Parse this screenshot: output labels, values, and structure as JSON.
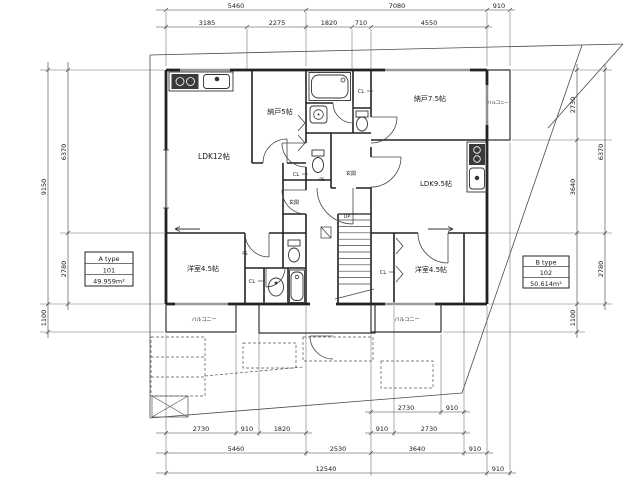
{
  "plan": {
    "unit_tables": {
      "a": {
        "type_label": "A type",
        "unit_no": "101",
        "area": "49.959m²"
      },
      "b": {
        "type_label": "B type",
        "unit_no": "102",
        "area": "50.614m²"
      }
    },
    "rooms": {
      "ldk_a": "LDK12帖",
      "nando_a": "納戸5帖",
      "nando_b": "納戸7.5帖",
      "ldk_b": "LDK9.5帖",
      "bedroom_a": "洋室4.5帖",
      "bedroom_b": "洋室4.5帖",
      "entrance_a": "玄関",
      "entrance_b": "玄関",
      "closet": "CL",
      "pipe_space": "PS",
      "stairs_up": "UP",
      "balcony": "バルコニー"
    },
    "dimensions": {
      "top_row1": [
        "5460",
        "7080",
        "910"
      ],
      "top_row2": [
        "3185",
        "2275",
        "1820",
        "710",
        "4550"
      ],
      "left_outer": [
        "9150",
        "1100"
      ],
      "left_inner": [
        "6370",
        "2780"
      ],
      "right_inner": [
        "2730",
        "3640",
        "1100"
      ],
      "right_outer": [
        "6370",
        "2780"
      ],
      "bottom_row1": [
        "2730",
        "910"
      ],
      "bottom_row2": [
        "2730",
        "910",
        "1820",
        "910",
        "2730"
      ],
      "bottom_row3": [
        "5460",
        "2530",
        "3640",
        "910"
      ],
      "bottom_row4": [
        "12540",
        "910"
      ]
    },
    "colors": {
      "line": "#2a2a2a",
      "background": "#ffffff"
    }
  }
}
